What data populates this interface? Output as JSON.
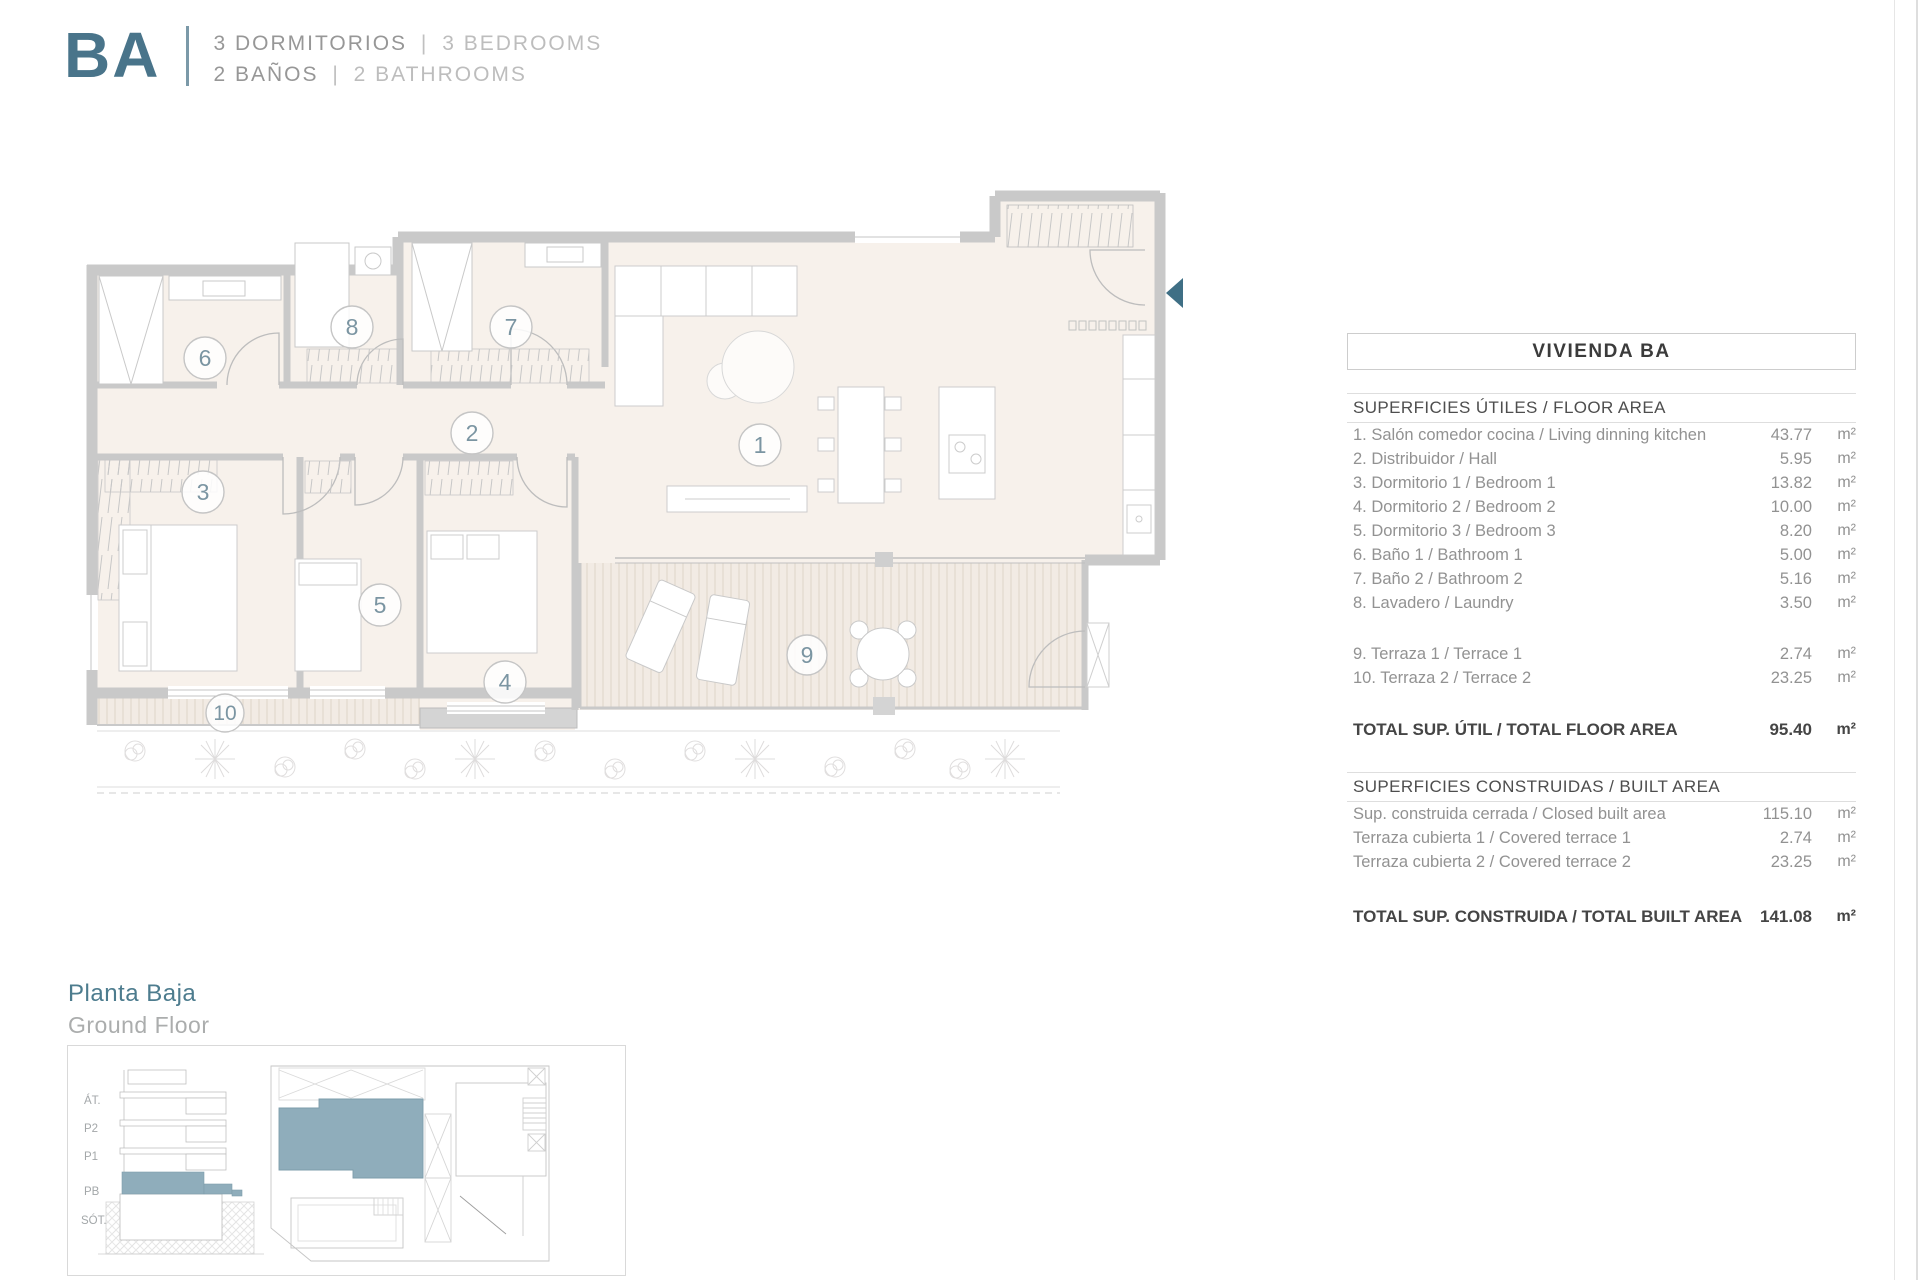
{
  "header": {
    "code": "BA",
    "line1": {
      "es": "3 DORMITORIOS",
      "sep": "|",
      "en": "3 BEDROOMS"
    },
    "line2": {
      "es": "2 BAÑOS",
      "sep": "|",
      "en": "2 BATHROOMS"
    }
  },
  "panel": {
    "title": "VIVIENDA BA",
    "s1": {
      "header": "SUPERFICIES ÚTILES / FLOOR AREA",
      "rows": [
        {
          "label": "1. Salón comedor cocina / Living dinning kitchen",
          "value": "43.77",
          "unit": "m²"
        },
        {
          "label": "2. Distribuidor / Hall",
          "value": "5.95",
          "unit": "m²"
        },
        {
          "label": "3. Dormitorio 1 / Bedroom 1",
          "value": "13.82",
          "unit": "m²"
        },
        {
          "label": "4. Dormitorio 2 / Bedroom 2",
          "value": "10.00",
          "unit": "m²"
        },
        {
          "label": "5. Dormitorio 3 / Bedroom 3",
          "value": "8.20",
          "unit": "m²"
        },
        {
          "label": "6. Baño 1 / Bathroom 1",
          "value": "5.00",
          "unit": "m²"
        },
        {
          "label": "7. Baño 2 / Bathroom 2",
          "value": "5.16",
          "unit": "m²"
        },
        {
          "label": "8. Lavadero / Laundry",
          "value": "3.50",
          "unit": "m²"
        }
      ],
      "terraces": [
        {
          "label": "9. Terraza 1 / Terrace 1",
          "value": "2.74",
          "unit": "m²"
        },
        {
          "label": "10. Terraza 2 / Terrace 2",
          "value": "23.25",
          "unit": "m²"
        }
      ],
      "total": {
        "label": "TOTAL SUP. ÚTIL / TOTAL FLOOR AREA",
        "value": "95.40",
        "unit": "m²"
      }
    },
    "s2": {
      "header": "SUPERFICIES CONSTRUIDAS / BUILT AREA",
      "rows": [
        {
          "label": "Sup. construida cerrada / Closed built area",
          "value": "115.10",
          "unit": "m²"
        },
        {
          "label": "Terraza cubierta 1 / Covered terrace 1",
          "value": "2.74",
          "unit": "m²"
        },
        {
          "label": "Terraza cubierta 2 / Covered terrace 2",
          "value": "23.25",
          "unit": "m²"
        }
      ],
      "total": {
        "label": "TOTAL SUP. CONSTRUIDA /  TOTAL BUILT AREA",
        "value": "141.08",
        "unit": "m²"
      }
    }
  },
  "plan": {
    "labels": [
      "1",
      "2",
      "3",
      "4",
      "5",
      "6",
      "7",
      "8",
      "9",
      "10"
    ]
  },
  "footer": {
    "floor_es": "Planta Baja",
    "floor_en": "Ground Floor",
    "levels": [
      "ÁT.",
      "P2",
      "P1",
      "PB",
      "SÓT."
    ]
  },
  "colors": {
    "accent": "#49748a",
    "mini_teal": "#8fadbb",
    "wall_gray": "#c9c9c9"
  }
}
